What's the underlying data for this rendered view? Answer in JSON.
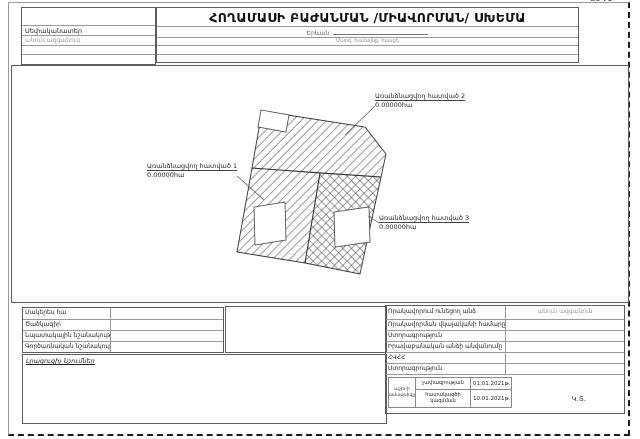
{
  "page": {
    "corner_mark": "ՁԵՎ 2",
    "title": "ՀՈՂԱՄԱՍԻ ԲԱԺԱՆՄԱՆ /ՄԻԱՎՈՐՄԱՆ/ ՍԽԵՄԱ"
  },
  "header": {
    "owner_label": "Սեփականատեր",
    "owner_placeholder": "անուն ազգանուն",
    "location_value": "Երևան",
    "location_hint": "Մարզ, համայնք, հասցե"
  },
  "drawing": {
    "labels": [
      {
        "title": "Առանձնացվող հատված 1",
        "area": "0.00000հա"
      },
      {
        "title": "Առանձնացվող հատված 2",
        "area": "0.00000հա"
      },
      {
        "title": "Առանձնացվող հատված 3",
        "area": "0.00000հա"
      }
    ]
  },
  "left_table": {
    "rows": [
      "Մակերես հա",
      "Ծածկագիր",
      "Նպատակային նշանակություն",
      "Գործառնական նշանակություն"
    ]
  },
  "notes": {
    "label": "Լրացուցիչ նշումներ"
  },
  "right_table": {
    "rows": [
      {
        "label": "Որակավորում ունեցող անձ",
        "value": "անուն ազգանուն"
      },
      {
        "label": "Որակավորման վկայականի համարը",
        "value": ""
      },
      {
        "label": "Ստորագրություն",
        "value": ""
      },
      {
        "label": "Իրավաբանական անձի անվանումը",
        "value": ""
      },
      {
        "label": "ՀՎՀՀ",
        "value": ""
      },
      {
        "label": "Ստորագրություն",
        "value": ""
      }
    ],
    "dates": {
      "group_label": "աշխ-ի ամսաթիվը",
      "rows": [
        {
          "label": "չափագրության",
          "value": "01.01.2021թ."
        },
        {
          "label": "հատակագծի կազմման",
          "value": "10.01.2021թ."
        }
      ]
    },
    "seal": "Կ.Տ."
  },
  "colors": {
    "line_dark": "#5c5c5c",
    "line_light": "#999999",
    "placeholder_gray": "#9a9a9a",
    "ink": "#1a1a1a"
  }
}
